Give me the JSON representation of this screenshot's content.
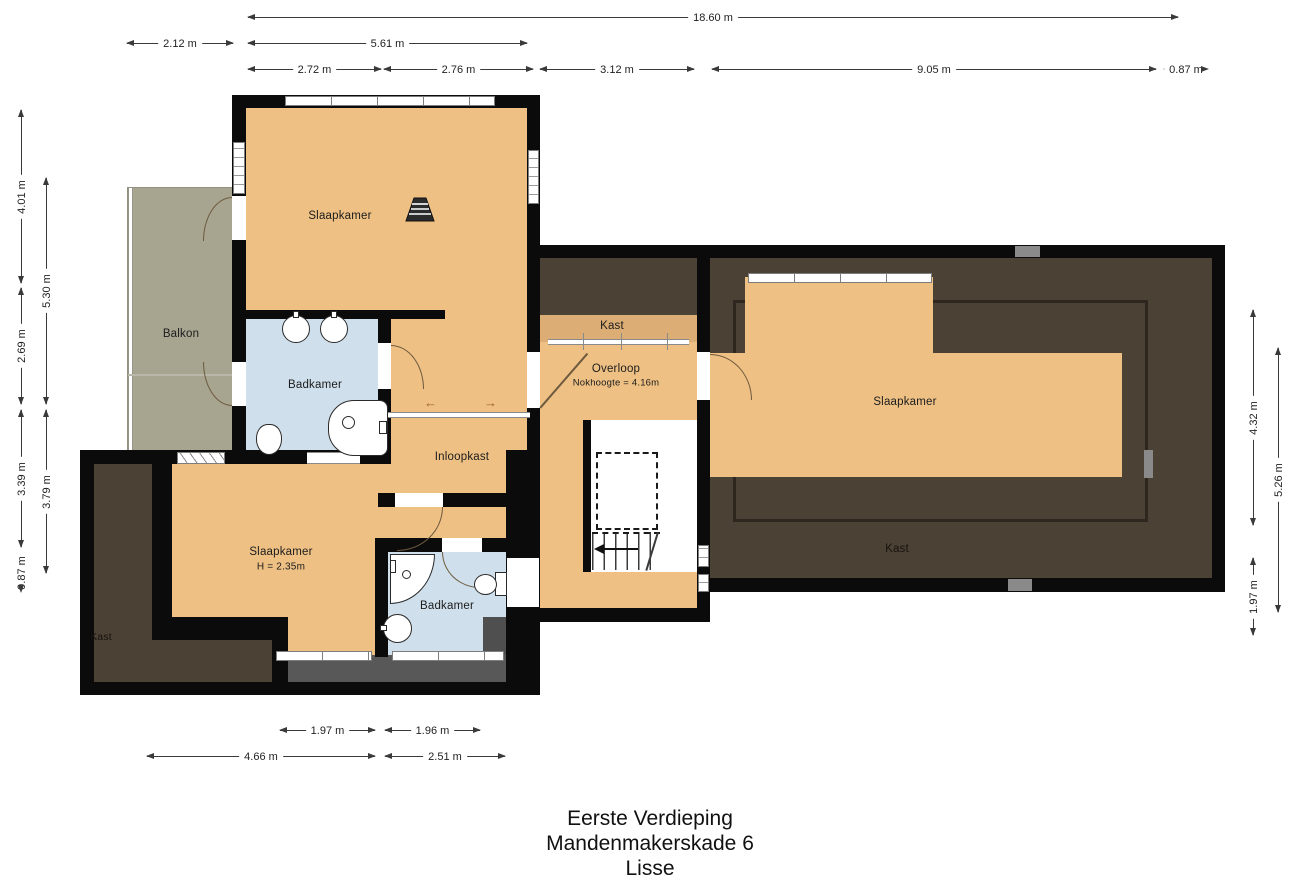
{
  "title": {
    "floor": "Eerste Verdieping",
    "address": "Mandenmakerskade 6",
    "city": "Lisse"
  },
  "rooms": {
    "slaapkamer_nw": "Slaapkamer",
    "balkon": "Balkon",
    "badkamer_nw": "Badkamer",
    "inloopkast": "Inloopkast",
    "kast_center": "Kast",
    "overloop": "Overloop",
    "overloop_note": "Nokhoogte = 4.16m",
    "slaapkamer_e": "Slaapkamer",
    "kast_e": "Kast",
    "slaapkamer_sw": "Slaapkamer",
    "slaapkamer_sw_note": "H = 2.35m",
    "badkamer_s": "Badkamer",
    "kast_sw": "Kast"
  },
  "dimensions": {
    "top_total": "18.60 m",
    "top_2_12": "2.12 m",
    "top_5_61": "5.61 m",
    "top_2_72": "2.72 m",
    "top_2_76": "2.76 m",
    "top_3_12": "3.12 m",
    "top_9_05": "9.05 m",
    "top_0_87": "0.87 m",
    "left_4_01": "4.01 m",
    "left_2_69": "2.69 m",
    "left_3_39": "3.39 m",
    "left_0_87": "0.87 m",
    "left_5_30": "5.30 m",
    "left_3_79": "3.79 m",
    "right_4_32": "4.32 m",
    "right_1_97": "1.97 m",
    "right_5_26": "5.26 m",
    "bottom_1_97": "1.97 m",
    "bottom_1_96": "1.96 m",
    "bottom_4_66": "4.66 m",
    "bottom_2_51": "2.51 m"
  },
  "icons": {
    "slide_arrow_left": "←",
    "slide_arrow_right": "→"
  },
  "colors": {
    "wall": "#0b0b0b",
    "floor_tan": "#eec084",
    "floor_tan_dark": "#dcae76",
    "balkon_green": "#a7a490",
    "bath_blue": "#cfdfeb",
    "attic_brown": "#4b4134",
    "void_gray": "#585858",
    "dim_line": "#3a3a3a"
  }
}
